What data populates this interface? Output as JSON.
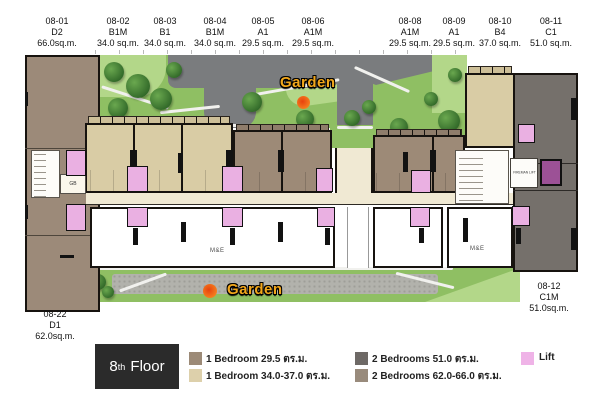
{
  "top_labels": [
    {
      "unit": "08-01",
      "type": "D2",
      "area": "66.0sq.m."
    },
    {
      "unit": "08-02",
      "type": "B1M",
      "area": "34.0 sq.m."
    },
    {
      "unit": "08-03",
      "type": "B1",
      "area": "34.0 sq.m."
    },
    {
      "unit": "08-04",
      "type": "B1M",
      "area": "34.0 sq.m."
    },
    {
      "unit": "08-05",
      "type": "A1",
      "area": "29.5 sq.m."
    },
    {
      "unit": "08-06",
      "type": "A1M",
      "area": "29.5 sq.m."
    },
    {
      "unit": "08-08",
      "type": "A1M",
      "area": "29.5 sq.m."
    },
    {
      "unit": "08-09",
      "type": "A1",
      "area": "29.5 sq.m."
    },
    {
      "unit": "08-10",
      "type": "B4",
      "area": "37.0 sq.m."
    },
    {
      "unit": "08-11",
      "type": "C1",
      "area": "51.0 sq.m."
    }
  ],
  "bottom_left_label": {
    "unit": "08-22",
    "type": "D1",
    "area": "62.0sq.m."
  },
  "bottom_right_label": {
    "unit": "08-12",
    "type": "C1M",
    "area": "51.0sq.m."
  },
  "garden": {
    "top": "Garden",
    "bottom": "Garden"
  },
  "rooms": {
    "me_large": "M&E",
    "me_small": "M&E",
    "fireman_lift": "FIREMAN LIFT",
    "gb": "GB"
  },
  "floor_badge": {
    "number": "8",
    "ordinal": "th",
    "word": "Floor"
  },
  "legend": {
    "items": [
      {
        "swatch": "#9c8a77",
        "label": "1 Bedroom 29.5 ตร.ม."
      },
      {
        "swatch": "#ddd0ab",
        "label": "1 Bedroom 34.0-37.0 ตร.ม."
      },
      {
        "swatch": "#6e6966",
        "label": "2 Bedrooms 51.0 ตร.ม."
      },
      {
        "swatch": "#998b7c",
        "label": "2 Bedrooms 62.0-66.0 ตร.ม."
      }
    ],
    "lift": {
      "swatch": "#efb3e7",
      "label": "Lift"
    }
  },
  "colors": {
    "unit_cream": "#d9cca5",
    "unit_brown": "#9d8a77",
    "unit_dark": "#75706b",
    "wing_taupe": "#9c8a79",
    "lift_pink": "#eab0e2",
    "fireman_purple": "#9c5196",
    "corridor": "#f0e9d3",
    "grass": "#8fbf63",
    "road": "#7a7c7e",
    "garden_text": "#f2a71b",
    "badge_bg": "#2b2b2b"
  }
}
